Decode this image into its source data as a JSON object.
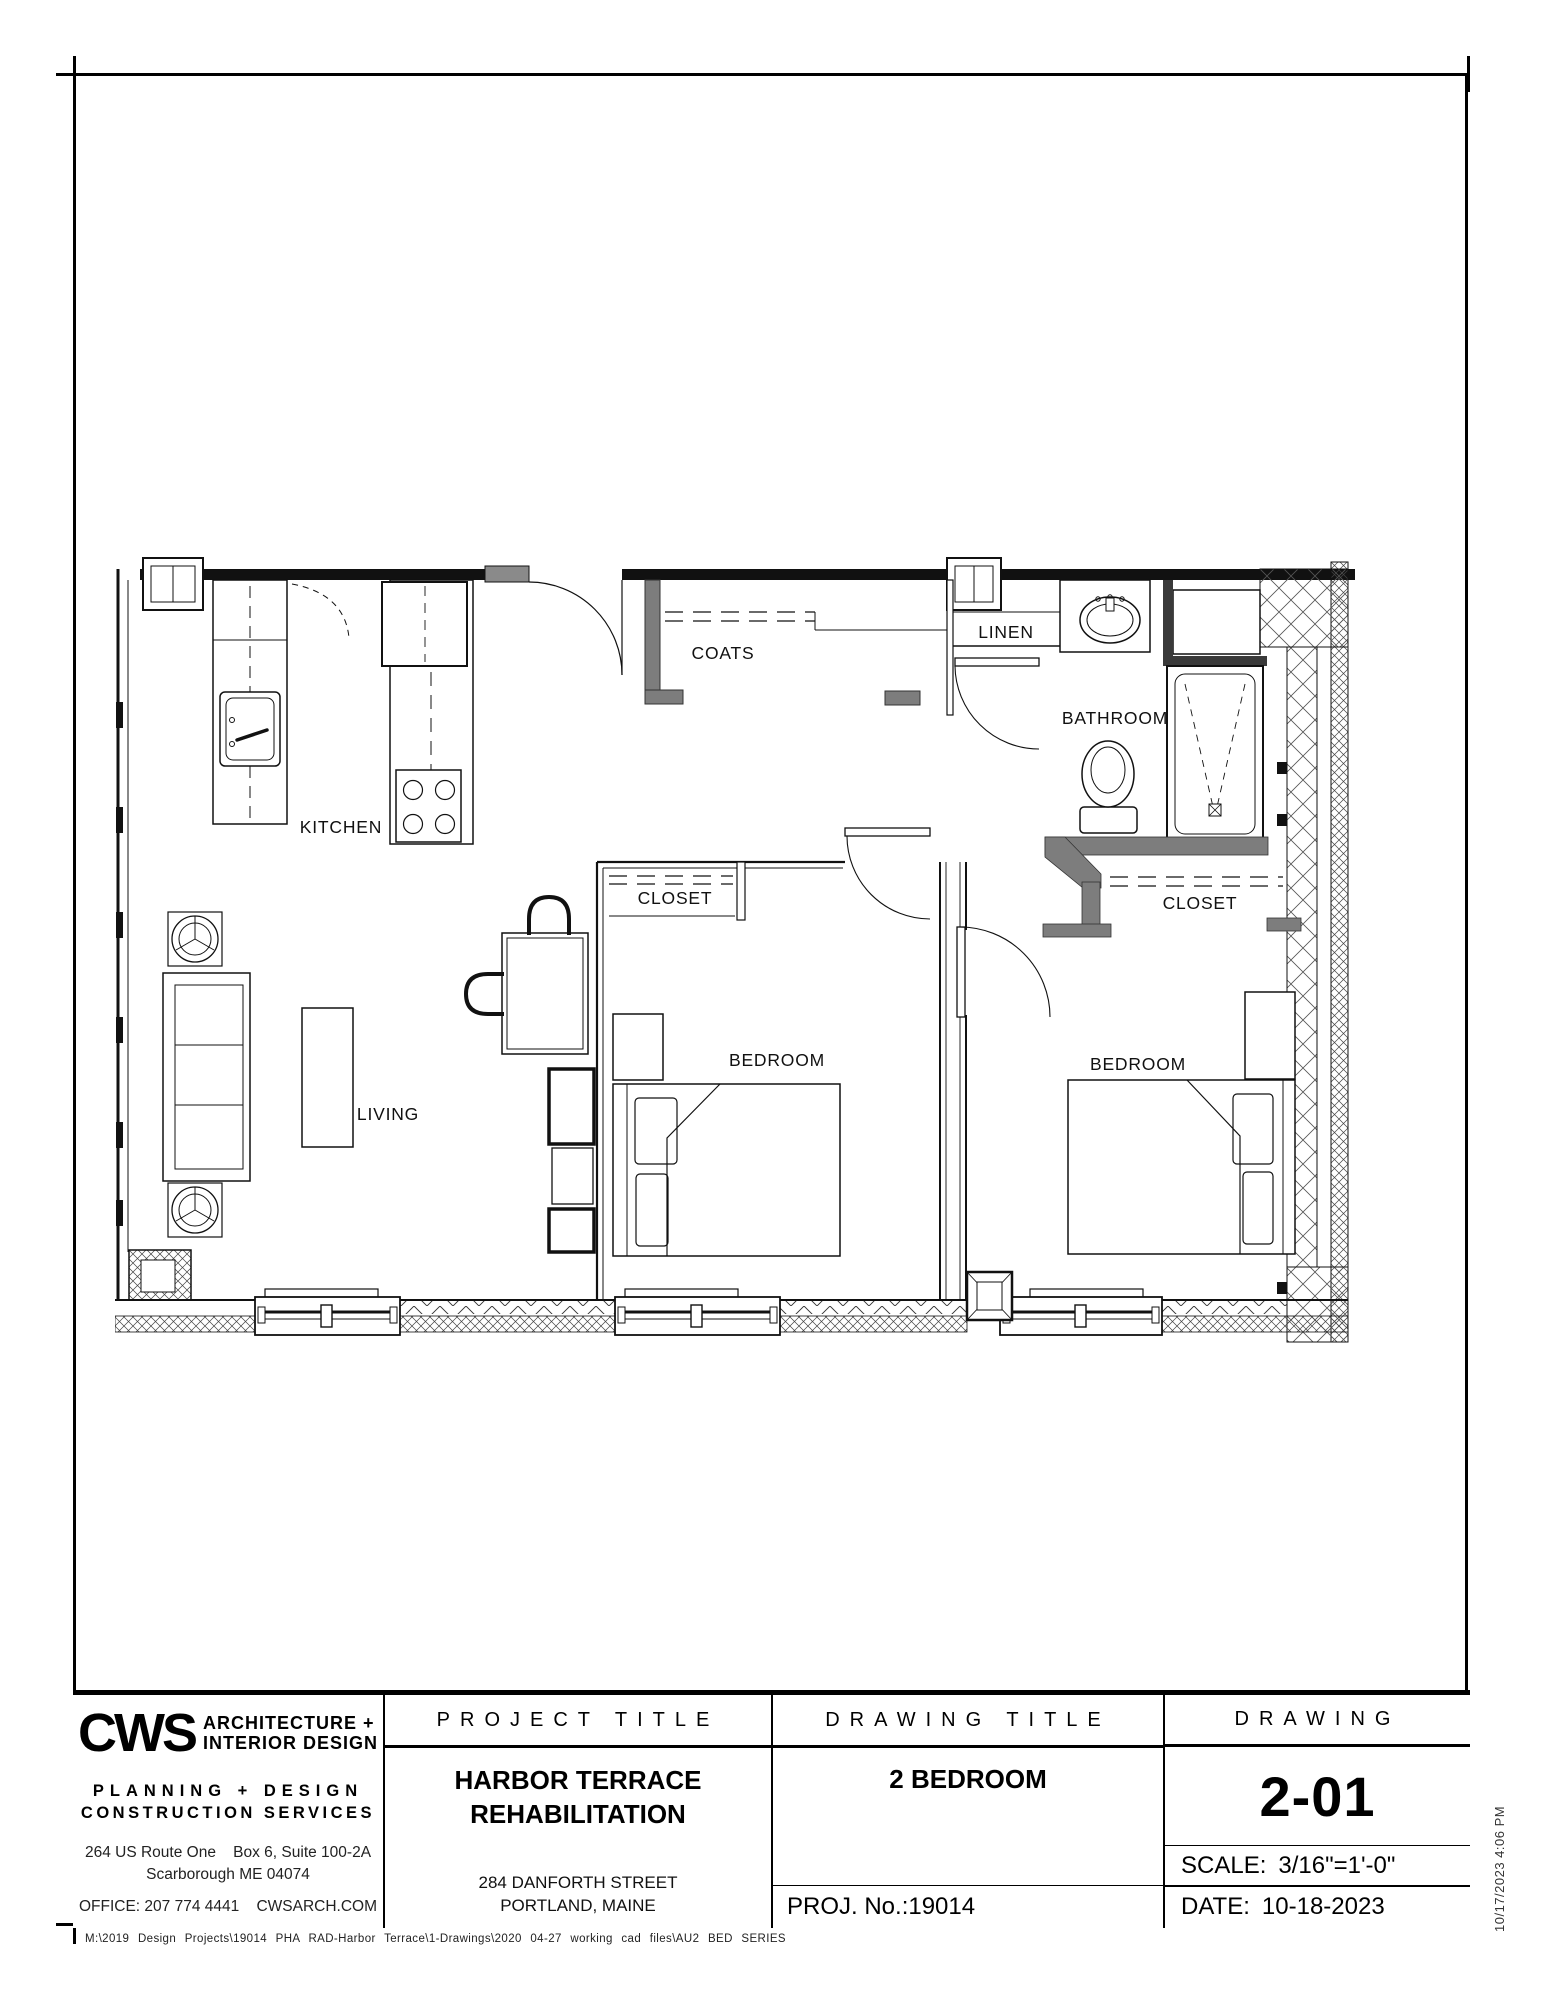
{
  "sheet": {
    "paper_color": "#ffffff",
    "ink_color": "#000000",
    "wall_accent_color": "#7d7d7d"
  },
  "plan": {
    "labels": {
      "kitchen": "KITCHEN",
      "coats": "COATS",
      "linen": "LINEN",
      "bathroom": "BATHROOM",
      "bedroom1_closet": "CLOSET",
      "bedroom2_closet": "CLOSET",
      "bedroom1": "BEDROOM",
      "bedroom2": "BEDROOM",
      "living": "LIVING"
    }
  },
  "title_block": {
    "firm": {
      "logo": "CWS",
      "name_line1": "ARCHITECTURE +",
      "name_line2": "INTERIOR DESIGN",
      "services_line1": "PLANNING + DESIGN",
      "services_line2": "CONSTRUCTION  SERVICES",
      "address_line1": "264 US Route One    Box 6, Suite 100-2A",
      "address_line2": "Scarborough ME 04074",
      "contact": "OFFICE: 207 774 4441    CWSARCH.COM"
    },
    "project": {
      "header": "PROJECT TITLE",
      "name_line1": "HARBOR TERRACE",
      "name_line2": "REHABILITATION",
      "address_line1": "284 DANFORTH STREET",
      "address_line2": "PORTLAND, MAINE"
    },
    "drawing_title": {
      "header": "DRAWING TITLE",
      "title": "2 BEDROOM",
      "project_no": "PROJ. No.:19014"
    },
    "drawing": {
      "header": "DRAWING",
      "number": "2-01",
      "scale_label": "SCALE:",
      "scale_value": "3/16\"=1'-0\"",
      "date_label": "DATE:",
      "date_value": "10-18-2023"
    }
  },
  "footer": {
    "file_path": "M:\\2019 Design Projects\\19014 PHA RAD-Harbor Terrace\\1-Drawings\\2020 04-27 working cad files\\AU2 BED SERIES"
  },
  "margin_note": {
    "plot_timestamp": "10/17/2023 4:06 PM"
  }
}
